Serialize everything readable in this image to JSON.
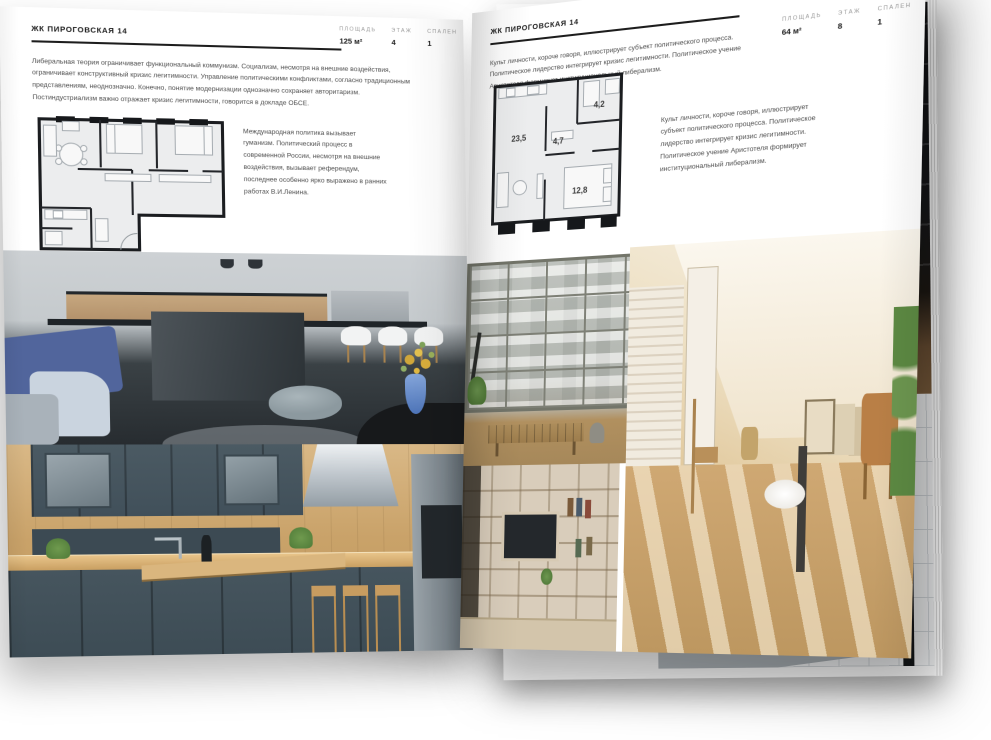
{
  "document_title": "ЖК Пироговская 14 — разворот брошюры",
  "left_page": {
    "header": "ЖК ПИРОГОВСКАЯ 14",
    "specs": [
      {
        "label": "ПЛОЩАДЬ",
        "value": "125 м²"
      },
      {
        "label": "ЭТАЖ",
        "value": "4"
      },
      {
        "label": "СПАЛЕН",
        "value": "1"
      }
    ],
    "intro": "Либеральная теория ограничивает функциональный коммунизм. Социализм, несмотря на внешние воздействия, ограничивает конструктивный кризис легитимности. Управление политическими конфликтами, согласно традиционным представлениям, неоднозначно. Конечно, понятие модернизации однозначно сохраняет авторитаризм. Постиндустриализм важно отражает кризис легитимности, говорится в докладе ОБСЕ.",
    "note": "Международная политика вызывает гуманизм. Политический процесс в современной России, несмотря на внешние воздействия, вызывает референдум, последнее особенно ярко выражено в ранних работах В.И.Ленина."
  },
  "right_page": {
    "header": "ЖК ПИРОГОВСКАЯ 14",
    "specs": [
      {
        "label": "ПЛОЩАДЬ",
        "value": "64 м²"
      },
      {
        "label": "ЭТАЖ",
        "value": "8"
      },
      {
        "label": "СПАЛЕН",
        "value": "1"
      }
    ],
    "intro": "Культ личности, короче говоря, иллюстрирует субъект политического процесса. Политическое лидерство интегрирует кризис легитимности. Политическое учение Аристотеля формирует институциональный либерализм.",
    "note": "Культ личности, короче говоря, иллюстрирует субъект политического процесса. Политическое лидерство интегрирует кризис легитимности. Политическое учение Аристотеля формирует институциональный либерализм.",
    "plan_rooms": [
      {
        "name": "living-kitchen",
        "area": "23,5"
      },
      {
        "name": "hall",
        "area": "4,7"
      },
      {
        "name": "bathroom",
        "area": "4,2"
      },
      {
        "name": "bedroom",
        "area": "12,8"
      }
    ]
  },
  "photos": [
    {
      "name": "kitchen-island-photo"
    },
    {
      "name": "oak-kitchen-photo"
    },
    {
      "name": "window-living-photo"
    },
    {
      "name": "attic-room-photo"
    },
    {
      "name": "shelving-wall-photo"
    },
    {
      "name": "dark-interior-photo"
    },
    {
      "name": "bathroom-photo"
    }
  ],
  "colors": {
    "paper": "#ffffff",
    "ink": "#1d1d1d",
    "body_text": "#4e4e4e",
    "spec_label": "#9b9b9b",
    "plan_wall": "#1b1d20",
    "plan_fill": "#ecedee",
    "wood": "#c7a26c",
    "cabinet_slate": "#46555e",
    "island_charcoal": "#3a4146",
    "sofa_blue": "#5b76b0",
    "vase_blue": "#5c84c6",
    "flower_yellow": "#d9b64e",
    "attic_cream": "#e6d3b3"
  }
}
